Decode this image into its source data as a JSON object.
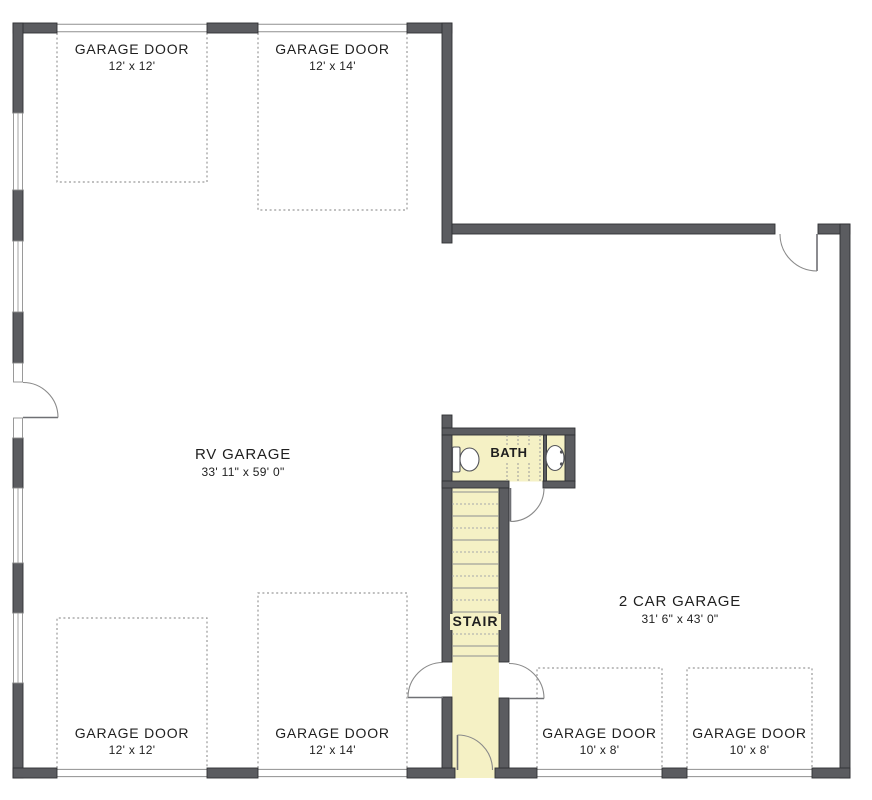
{
  "rooms": {
    "rv_garage": {
      "name": "RV GARAGE",
      "dims": "33' 11\" x 59' 0\""
    },
    "two_car_garage": {
      "name": "2 CAR GARAGE",
      "dims": "31' 6\" x 43' 0\""
    },
    "bath": {
      "name": "BATH"
    },
    "stair": {
      "name": "STAIR"
    }
  },
  "garage_doors": [
    {
      "label": "GARAGE DOOR",
      "size": "12' x 12'",
      "location": "top-left"
    },
    {
      "label": "GARAGE DOOR",
      "size": "12' x 14'",
      "location": "top-right"
    },
    {
      "label": "GARAGE DOOR",
      "size": "12' x 12'",
      "location": "bottom-left"
    },
    {
      "label": "GARAGE DOOR",
      "size": "12' x 14'",
      "location": "bottom-center-left"
    },
    {
      "label": "GARAGE DOOR",
      "size": "10' x 8'",
      "location": "bottom-center-right"
    },
    {
      "label": "GARAGE DOOR",
      "size": "10' x 8'",
      "location": "bottom-right"
    }
  ],
  "fixtures": [
    {
      "name": "toilet",
      "room": "bath"
    },
    {
      "name": "sink",
      "room": "bath"
    }
  ],
  "colors": {
    "wall": "#5b5c60",
    "wallline": "#2f3033",
    "floor": "#f5f1c5",
    "dash": "#9a9a9a",
    "line": "#8f8f8f",
    "text": "#1f1f1f",
    "bg": "#ffffff"
  }
}
